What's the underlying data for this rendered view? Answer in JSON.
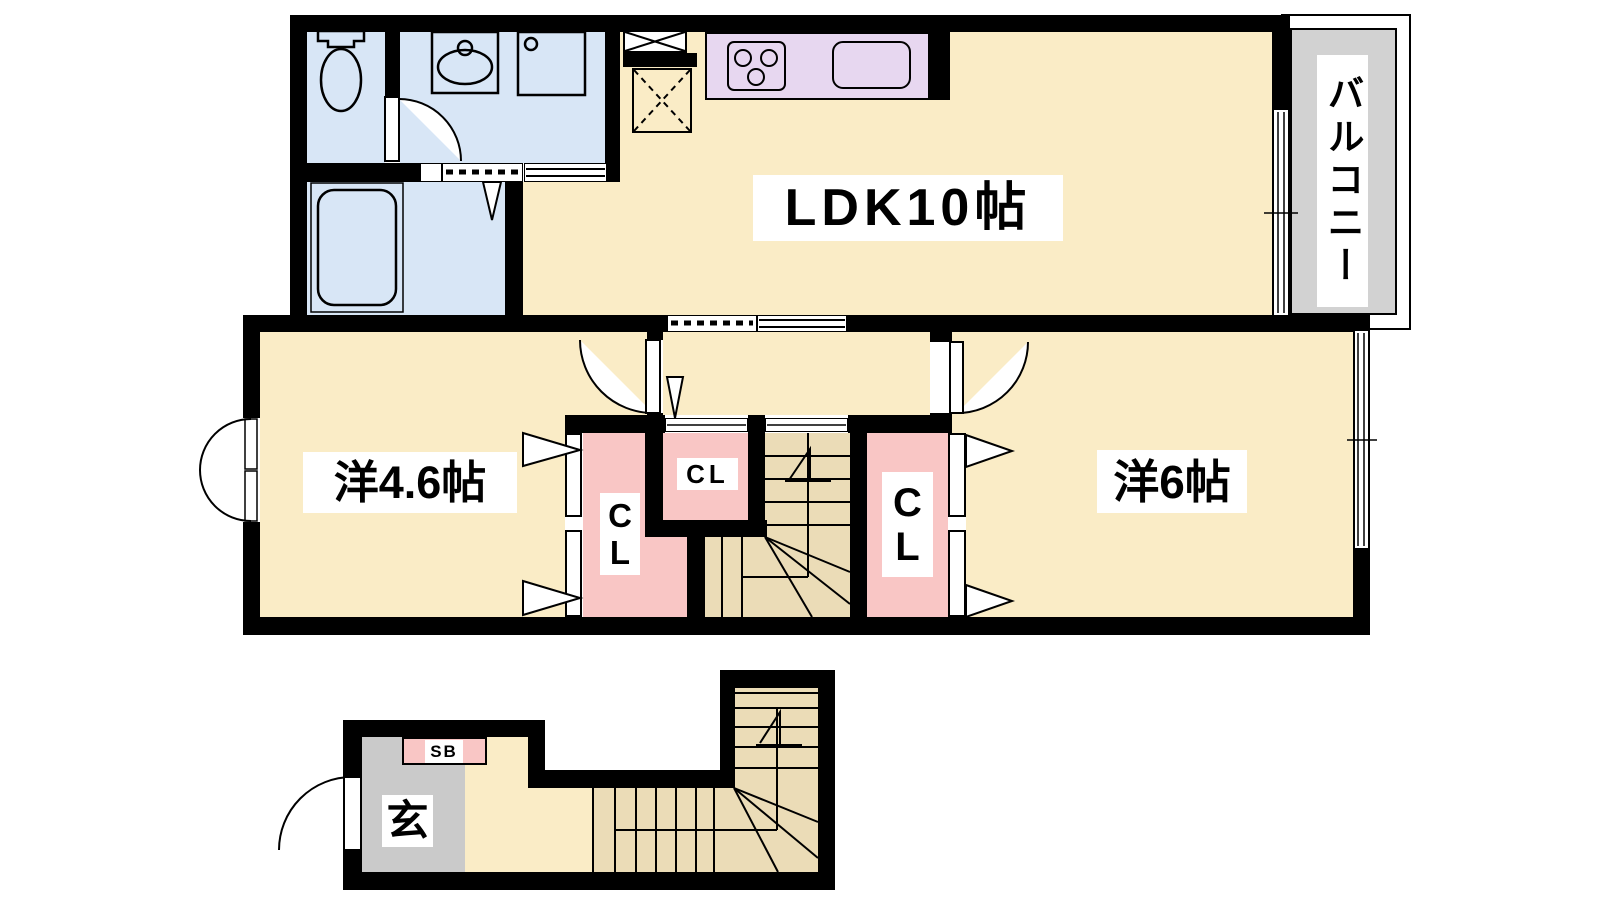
{
  "plan": {
    "rooms": {
      "ldk": {
        "label": "LDK10帖"
      },
      "western_4_6": {
        "label": "洋4.6帖"
      },
      "western_6": {
        "label": "洋6帖"
      },
      "balcony": {
        "label": "バルコニー"
      },
      "entrance": {
        "label": "玄"
      },
      "shoebox": {
        "label": "SB"
      },
      "closet_left": {
        "label": "CL"
      },
      "closet_center": {
        "label": "CL"
      },
      "closet_right": {
        "label": "CL"
      }
    },
    "colors": {
      "floor-cream": "#FAECC6",
      "stairs-tan": "#EBDCB7",
      "closet-pink": "#F9C6C5",
      "wet-blue": "#D8E6F6",
      "kitchen-purple": "#E7D7F0",
      "balcony-gray": "#D2D2D2",
      "entrance-gray": "#CACACA",
      "wall-black": "#000000"
    }
  }
}
